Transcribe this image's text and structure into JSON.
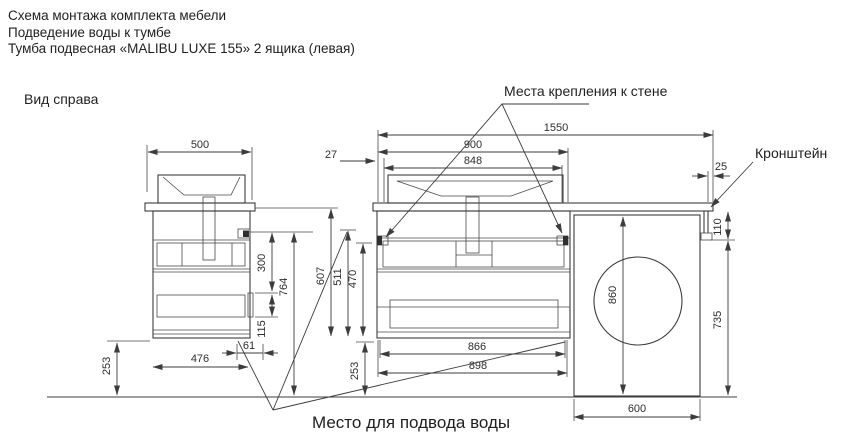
{
  "titles": {
    "line1": "Схема монтажа комплекта мебели",
    "line2": "Подведение воды к тумбе",
    "line3": "Тумба подвесная «MALIBU LUXE 155»  2 ящика (левая)"
  },
  "labels": {
    "view": "Вид справа",
    "wall_mount": "Места крепления к стене",
    "bracket": "Кронштейн",
    "water_supply": "Место  для подвода воды"
  },
  "dimensions": {
    "side_depth": "500",
    "total_length": "1550",
    "vanity_width": "900",
    "mount_span": "848",
    "mount_offset": "27",
    "countertop_overhang": "25",
    "bracket_drop": "300",
    "floor_to_top": "764",
    "top_to_bottom": "607",
    "mount_to_bottom": "511",
    "drawer_to_bottom": "470",
    "handle_span": "115",
    "rear_offset": "61",
    "side_bottom_depth": "476",
    "side_floor_gap": "253",
    "front_floor_gap": "253",
    "bottom_width_inner": "866",
    "bottom_width_outer": "898",
    "wm_height": "860",
    "bracket_height": "110",
    "wm_clearance": "735",
    "wm_width": "600"
  }
}
